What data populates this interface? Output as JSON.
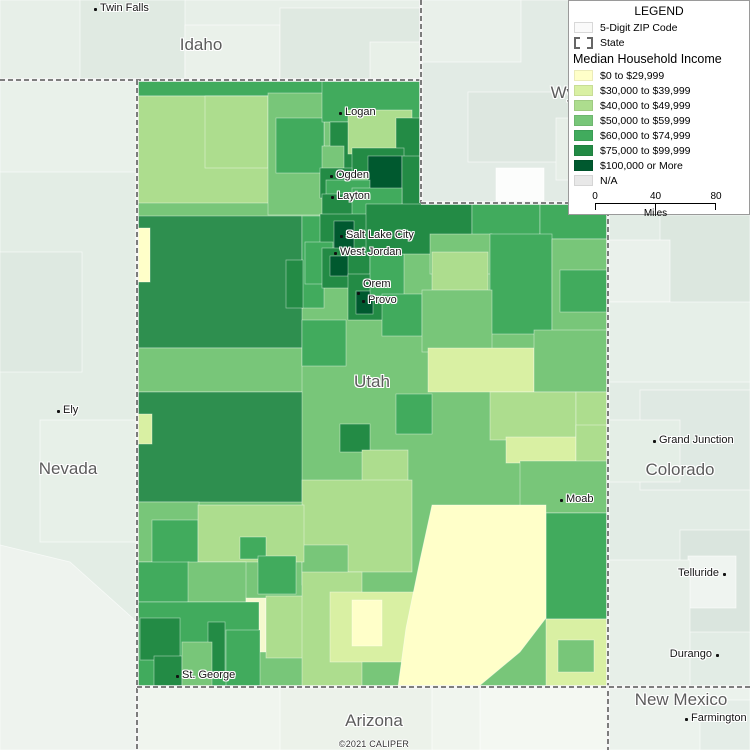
{
  "map": {
    "attribution": "©2021 CALIPER",
    "utah_outline": "137,80 421,80 421,203 608,203 608,687 137,687",
    "neighbors": [
      {
        "r": [
          0,
          0,
          421,
          80
        ],
        "f": "#E7EFE8"
      },
      {
        "r": [
          80,
          0,
          105,
          80
        ],
        "f": "#E0EAE2"
      },
      {
        "r": [
          185,
          25,
          95,
          55
        ],
        "f": "#EAF1EA"
      },
      {
        "r": [
          280,
          8,
          141,
          72
        ],
        "f": "#DFE9E1"
      },
      {
        "r": [
          370,
          42,
          51,
          38
        ],
        "f": "#E8F0E8"
      },
      {
        "r": [
          421,
          0,
          329,
          203
        ],
        "f": "#E2EBE5"
      },
      {
        "r": [
          421,
          0,
          100,
          62
        ],
        "f": "#E9F0EA"
      },
      {
        "r": [
          468,
          92,
          122,
          70
        ],
        "f": "#DDE7E0"
      },
      {
        "r": [
          496,
          168,
          48,
          38
        ],
        "f": "#FCFDFC"
      },
      {
        "r": [
          556,
          118,
          62,
          62
        ],
        "f": "#E6EEE7"
      },
      {
        "r": [
          0,
          80,
          137,
          670
        ],
        "f": "#E3EDE5"
      },
      {
        "r": [
          0,
          80,
          137,
          92
        ],
        "f": "#E9F1EA"
      },
      {
        "r": [
          0,
          252,
          82,
          120
        ],
        "f": "#DEE9E1"
      },
      {
        "r": [
          40,
          420,
          97,
          122
        ],
        "f": "#E7F0E8"
      },
      {
        "p": "0,545 70,562 137,622 137,750 0,750",
        "f": "#EEF3EE"
      },
      {
        "r": [
          608,
          203,
          142,
          484
        ],
        "f": "#E2ECE5"
      },
      {
        "r": [
          660,
          215,
          90,
          92
        ],
        "f": "#DCE7DF"
      },
      {
        "r": [
          608,
          240,
          62,
          62
        ],
        "f": "#EAF1EB"
      },
      {
        "r": [
          608,
          302,
          142,
          80
        ],
        "f": "#E6EFE8"
      },
      {
        "r": [
          640,
          390,
          110,
          100
        ],
        "f": "#DFE9E3"
      },
      {
        "r": [
          608,
          420,
          72,
          62
        ],
        "f": "#E4EEE6"
      },
      {
        "r": [
          680,
          530,
          70,
          102
        ],
        "f": "#DAE5DE"
      },
      {
        "r": [
          688,
          556,
          48,
          52
        ],
        "f": "#EFF4F0"
      },
      {
        "r": [
          608,
          560,
          82,
          127
        ],
        "f": "#E7EFE8"
      },
      {
        "r": [
          137,
          687,
          471,
          63
        ],
        "f": "#F0F5EE"
      },
      {
        "r": [
          280,
          687,
          152,
          63
        ],
        "f": "#ECF2EA"
      },
      {
        "r": [
          480,
          687,
          128,
          63
        ],
        "f": "#F4F8F2"
      },
      {
        "r": [
          608,
          687,
          142,
          63
        ],
        "f": "#EBF2EC"
      },
      {
        "r": [
          700,
          700,
          50,
          50
        ],
        "f": "#E4EDE7"
      }
    ],
    "utah_regions": [
      {
        "r": [
          137,
          80,
          471,
          607
        ],
        "f": "#78C679"
      },
      {
        "r": [
          137,
          80,
          285,
          16
        ],
        "f": "#41AB5D"
      },
      {
        "r": [
          137,
          96,
          133,
          107
        ],
        "f": "#ADDD8E"
      },
      {
        "r": [
          205,
          96,
          63,
          72
        ],
        "f": "#ADDD8E"
      },
      {
        "r": [
          268,
          93,
          56,
          122
        ],
        "f": "#78C679"
      },
      {
        "r": [
          276,
          118,
          48,
          55
        ],
        "f": "#41AB5D"
      },
      {
        "r": [
          322,
          80,
          99,
          42
        ],
        "f": "#41AB5D"
      },
      {
        "r": [
          330,
          122,
          24,
          56
        ],
        "f": "#238B45"
      },
      {
        "r": [
          348,
          110,
          64,
          44
        ],
        "f": "#ADDD8E"
      },
      {
        "r": [
          396,
          118,
          25,
          62
        ],
        "f": "#238B45"
      },
      {
        "r": [
          352,
          148,
          52,
          24
        ],
        "f": "#238B45"
      },
      {
        "r": [
          368,
          156,
          34,
          38
        ],
        "f": "#00592F"
      },
      {
        "r": [
          402,
          156,
          19,
          49
        ],
        "f": "#238B45"
      },
      {
        "r": [
          322,
          146,
          22,
          48
        ],
        "f": "#78C679"
      },
      {
        "r": [
          320,
          168,
          32,
          30
        ],
        "f": "#238B45"
      },
      {
        "r": [
          326,
          180,
          44,
          20
        ],
        "f": "#41AB5D"
      },
      {
        "r": [
          322,
          194,
          44,
          28
        ],
        "f": "#238B45"
      },
      {
        "r": [
          352,
          188,
          50,
          34
        ],
        "f": "#41AB5D"
      },
      {
        "r": [
          137,
          216,
          165,
          132
        ],
        "f": "#2E8F4F"
      },
      {
        "r": [
          137,
          348,
          165,
          44
        ],
        "f": "#78C679"
      },
      {
        "r": [
          137,
          392,
          165,
          110
        ],
        "f": "#2E8F4F"
      },
      {
        "r": [
          137,
          228,
          13,
          54
        ],
        "f": "#FFFFC9"
      },
      {
        "r": [
          137,
          414,
          15,
          30
        ],
        "f": "#D9F0A3"
      },
      {
        "r": [
          302,
          216,
          22,
          92
        ],
        "f": "#41AB5D"
      },
      {
        "r": [
          320,
          214,
          50,
          42
        ],
        "f": "#238B45"
      },
      {
        "r": [
          334,
          221,
          20,
          29
        ],
        "f": "#00592F"
      },
      {
        "r": [
          305,
          242,
          28,
          42
        ],
        "f": "#41AB5D"
      },
      {
        "r": [
          322,
          248,
          48,
          40
        ],
        "f": "#238B45"
      },
      {
        "r": [
          330,
          256,
          18,
          20
        ],
        "f": "#00592F"
      },
      {
        "r": [
          286,
          260,
          17,
          48
        ],
        "f": "#238B45"
      },
      {
        "r": [
          348,
          274,
          42,
          46
        ],
        "f": "#238B45"
      },
      {
        "r": [
          356,
          291,
          17,
          23
        ],
        "f": "#00592F"
      },
      {
        "r": [
          370,
          254,
          34,
          42
        ],
        "f": "#41AB5D"
      },
      {
        "r": [
          382,
          294,
          40,
          42
        ],
        "f": "#41AB5D"
      },
      {
        "r": [
          366,
          204,
          106,
          50
        ],
        "f": "#238B45"
      },
      {
        "r": [
          472,
          203,
          68,
          32
        ],
        "f": "#41AB5D"
      },
      {
        "r": [
          540,
          203,
          68,
          36
        ],
        "f": "#41AB5D"
      },
      {
        "r": [
          430,
          234,
          62,
          40
        ],
        "f": "#78C679"
      },
      {
        "r": [
          432,
          252,
          56,
          54
        ],
        "f": "#ADDD8E"
      },
      {
        "r": [
          490,
          234,
          62,
          100
        ],
        "f": "#41AB5D"
      },
      {
        "r": [
          552,
          239,
          56,
          96
        ],
        "f": "#78C679"
      },
      {
        "r": [
          560,
          270,
          48,
          42
        ],
        "f": "#41AB5D"
      },
      {
        "r": [
          422,
          290,
          70,
          62
        ],
        "f": "#78C679"
      },
      {
        "r": [
          428,
          348,
          106,
          44
        ],
        "f": "#D9F0A3"
      },
      {
        "r": [
          534,
          330,
          74,
          62
        ],
        "f": "#78C679"
      },
      {
        "r": [
          490,
          392,
          86,
          48
        ],
        "f": "#ADDD8E"
      },
      {
        "r": [
          576,
          392,
          32,
          48
        ],
        "f": "#ADDD8E"
      },
      {
        "r": [
          506,
          437,
          70,
          26
        ],
        "f": "#D9F0A3"
      },
      {
        "r": [
          576,
          425,
          32,
          40
        ],
        "f": "#ADDD8E"
      },
      {
        "r": [
          520,
          461,
          88,
          52
        ],
        "f": "#78C679"
      },
      {
        "r": [
          546,
          513,
          62,
          106
        ],
        "f": "#41AB5D"
      },
      {
        "r": [
          546,
          619,
          62,
          68
        ],
        "f": "#D9F0A3"
      },
      {
        "r": [
          558,
          640,
          36,
          32
        ],
        "f": "#78C679"
      },
      {
        "r": [
          302,
          320,
          44,
          46
        ],
        "f": "#41AB5D"
      },
      {
        "r": [
          396,
          394,
          36,
          40
        ],
        "f": "#41AB5D"
      },
      {
        "r": [
          340,
          424,
          30,
          28
        ],
        "f": "#238B45"
      },
      {
        "r": [
          362,
          450,
          46,
          46
        ],
        "f": "#ADDD8E"
      },
      {
        "r": [
          302,
          480,
          110,
          92
        ],
        "f": "#ADDD8E"
      },
      {
        "r": [
          302,
          545,
          46,
          40
        ],
        "f": "#78C679"
      },
      {
        "r": [
          137,
          502,
          62,
          60
        ],
        "f": "#78C679"
      },
      {
        "r": [
          152,
          520,
          46,
          78
        ],
        "f": "#41AB5D"
      },
      {
        "r": [
          198,
          505,
          106,
          57
        ],
        "f": "#ADDD8E"
      },
      {
        "r": [
          240,
          537,
          26,
          22
        ],
        "f": "#41AB5D"
      },
      {
        "r": [
          258,
          556,
          38,
          38
        ],
        "f": "#41AB5D"
      },
      {
        "r": [
          137,
          562,
          52,
          40
        ],
        "f": "#41AB5D"
      },
      {
        "r": [
          188,
          562,
          58,
          40
        ],
        "f": "#78C679"
      },
      {
        "r": [
          246,
          598,
          20,
          54
        ],
        "f": "#F5F9CE"
      },
      {
        "r": [
          266,
          596,
          60,
          62
        ],
        "f": "#ADDD8E"
      },
      {
        "r": [
          302,
          572,
          60,
          115
        ],
        "f": "#ADDD8E"
      },
      {
        "r": [
          330,
          592,
          92,
          70
        ],
        "f": "#D9F0A3"
      },
      {
        "r": [
          352,
          600,
          30,
          46
        ],
        "f": "#FFFFC9"
      },
      {
        "p": "432,505 546,505 546,618 520,652 478,687 398,687 406,628 420,560",
        "f": "#FFFFC9"
      },
      {
        "r": [
          137,
          602,
          122,
          85
        ],
        "f": "#41AB5D"
      },
      {
        "r": [
          140,
          618,
          40,
          42
        ],
        "f": "#238B45"
      },
      {
        "r": [
          154,
          656,
          28,
          31
        ],
        "f": "#238B45"
      },
      {
        "r": [
          208,
          622,
          17,
          50
        ],
        "f": "#238B45"
      },
      {
        "r": [
          182,
          642,
          30,
          45
        ],
        "f": "#78C679"
      },
      {
        "r": [
          226,
          630,
          34,
          57
        ],
        "f": "#41AB5D"
      }
    ],
    "borders": [
      {
        "pts": "0,80 421,80"
      },
      {
        "pts": "421,0 421,203"
      },
      {
        "pts": "421,203 750,203"
      },
      {
        "pts": "137,80 137,750"
      },
      {
        "pts": "608,203 608,750"
      },
      {
        "pts": "137,687 750,687"
      }
    ],
    "state_labels": [
      {
        "text": "Idaho",
        "x": 201,
        "y": 45
      },
      {
        "text": "Wyoming",
        "x": 586,
        "y": 93
      },
      {
        "text": "Nevada",
        "x": 68,
        "y": 469
      },
      {
        "text": "Utah",
        "x": 372,
        "y": 382
      },
      {
        "text": "Colorado",
        "x": 680,
        "y": 470
      },
      {
        "text": "Arizona",
        "x": 374,
        "y": 721
      },
      {
        "text": "New Mexico",
        "x": 681,
        "y": 700
      }
    ],
    "city_labels": [
      {
        "text": "Twin Falls",
        "x": 95,
        "y": 9,
        "side": "right"
      },
      {
        "text": "Logan",
        "x": 340,
        "y": 113,
        "side": "right"
      },
      {
        "text": "Ogden",
        "x": 331,
        "y": 176,
        "side": "right"
      },
      {
        "text": "Layton",
        "x": 332,
        "y": 197,
        "side": "right"
      },
      {
        "text": "Salt Lake City",
        "x": 341,
        "y": 236,
        "side": "right"
      },
      {
        "text": "West Jordan",
        "x": 335,
        "y": 253,
        "side": "right"
      },
      {
        "text": "Orem",
        "x": 358,
        "y": 293,
        "side": "right",
        "tdy": -8
      },
      {
        "text": "Provo",
        "x": 363,
        "y": 301,
        "side": "right"
      },
      {
        "text": "Ely",
        "x": 58,
        "y": 411,
        "side": "right"
      },
      {
        "text": "Grand Junction",
        "x": 654,
        "y": 441,
        "side": "right"
      },
      {
        "text": "Moab",
        "x": 561,
        "y": 500,
        "side": "right"
      },
      {
        "text": "St. George",
        "x": 177,
        "y": 676,
        "side": "right"
      },
      {
        "text": "Telluride",
        "x": 724,
        "y": 574,
        "side": "left"
      },
      {
        "text": "Durango",
        "x": 717,
        "y": 655,
        "side": "left"
      },
      {
        "text": "Farmington",
        "x": 686,
        "y": 719,
        "side": "right"
      }
    ]
  },
  "legend": {
    "title": "LEGEND",
    "zip_label": "5-Digit ZIP Code",
    "state_label": "State",
    "heading": "Median Household Income",
    "classes": [
      {
        "label": "$0 to $29,999",
        "color": "#FFFFC9"
      },
      {
        "label": "$30,000 to $39,999",
        "color": "#D9F0A3"
      },
      {
        "label": "$40,000 to $49,999",
        "color": "#ADDD8E"
      },
      {
        "label": "$50,000 to $59,999",
        "color": "#78C679"
      },
      {
        "label": "$60,000 to $74,999",
        "color": "#41AB5D"
      },
      {
        "label": "$75,000 to $99,999",
        "color": "#238B45"
      },
      {
        "label": "$100,000 or More",
        "color": "#00592F"
      },
      {
        "label": "N/A",
        "color": "#E8E8E8"
      }
    ],
    "scale": {
      "ticks": [
        "0",
        "40",
        "80"
      ],
      "unit": "Miles"
    }
  }
}
